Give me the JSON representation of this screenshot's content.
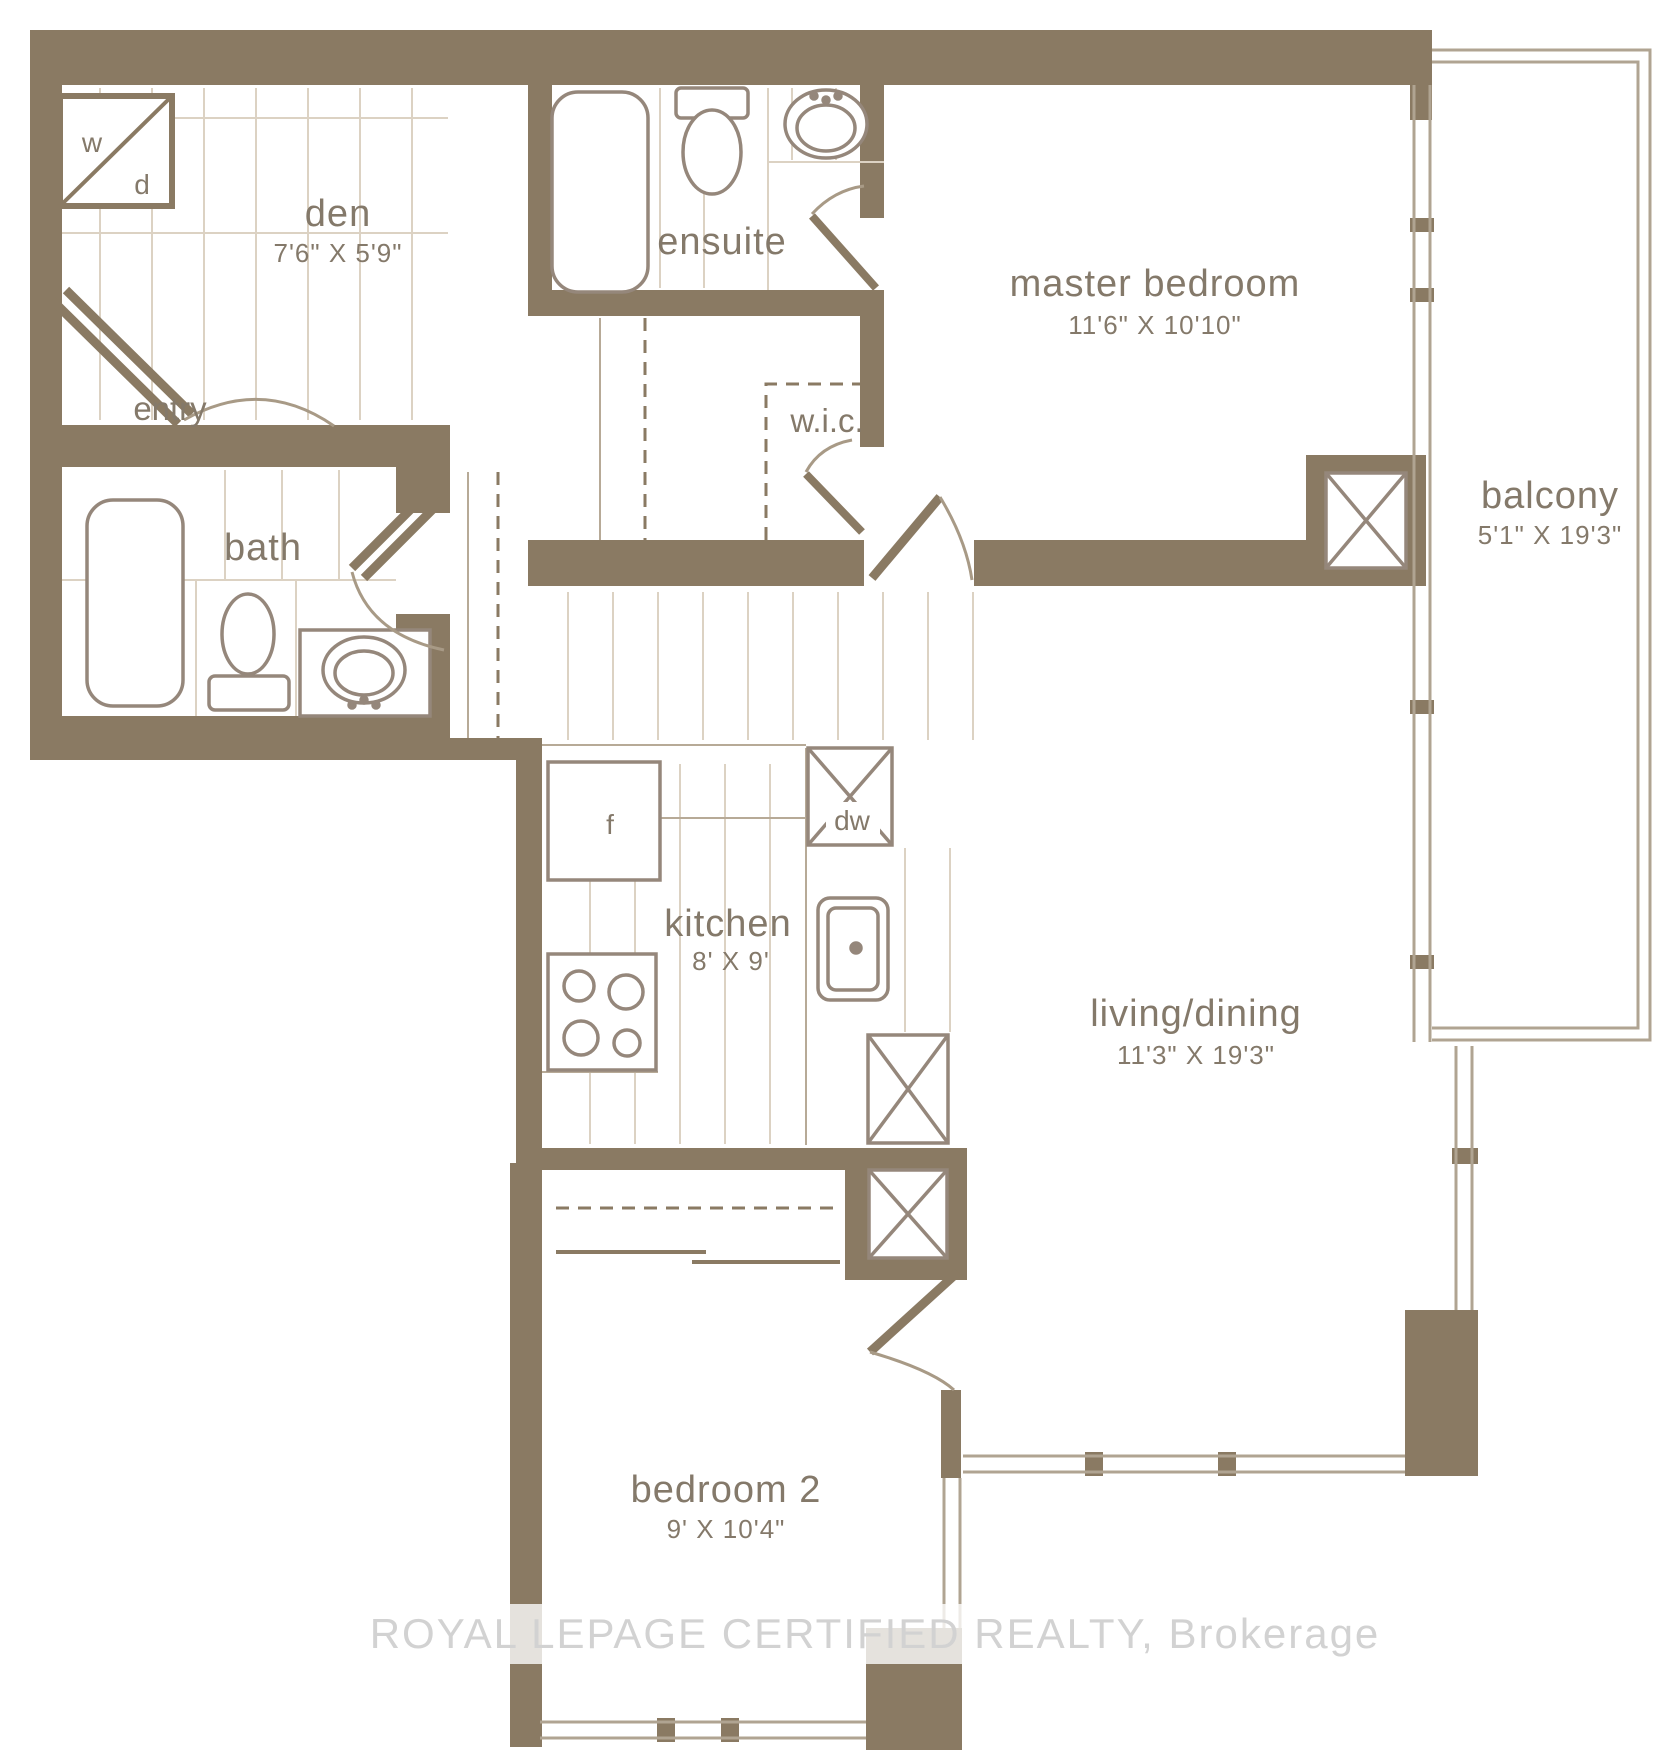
{
  "watermark": "ROYAL LEPAGE CERTIFIED REALTY, Brokerage",
  "rooms": {
    "den": {
      "label": "den",
      "dims": "7'6\" X 5'9\""
    },
    "entry": {
      "label": "entry"
    },
    "bath": {
      "label": "bath"
    },
    "ensuite": {
      "label": "ensuite"
    },
    "wic": {
      "label": "w.i.c."
    },
    "master_bedroom": {
      "label": "master bedroom",
      "dims": "11'6\" X 10'10\""
    },
    "balcony": {
      "label": "balcony",
      "dims": "5'1\" X 19'3\""
    },
    "kitchen": {
      "label": "kitchen",
      "dims": "8' X 9'"
    },
    "living_dining": {
      "label": "living/dining",
      "dims": "11'3\" X 19'3\""
    },
    "bedroom_2": {
      "label": "bedroom 2",
      "dims": "9' X 10'4\""
    }
  },
  "fixtures": {
    "washer": "w",
    "dryer": "d",
    "fridge": "f",
    "dishwasher": "dw"
  },
  "colors": {
    "wall": "#8a7a63",
    "fixture_line": "#95877b",
    "hatch_line": "#dcd2c3",
    "text": "#84796a",
    "watermark_text": "#d2d2d2"
  }
}
